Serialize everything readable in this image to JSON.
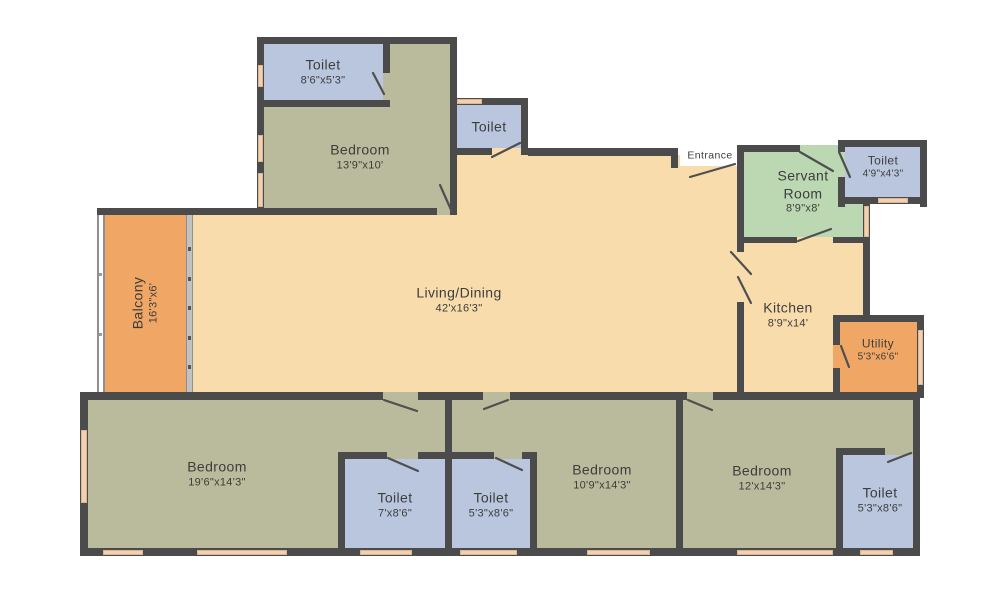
{
  "title": "Apartment Floor Plan",
  "colors": {
    "wall": "#4b4b4b",
    "bedroom": "#b9bb9c",
    "toilet": "#b9c6de",
    "living": "#f8dcab",
    "balcony": "#f0a765",
    "utility": "#f0a765",
    "servant": "#bcd8b3",
    "window": "#f4d0b0",
    "text": "#3d3d3d"
  },
  "rooms": {
    "toilet_tl": {
      "name": "Toilet",
      "dims": "8'6\"x5'3\""
    },
    "bedroom_tl": {
      "name": "Bedroom",
      "dims": "13'9\"x10'"
    },
    "toilet_mid": {
      "name": "Toilet",
      "dims": ""
    },
    "entrance": {
      "name": "Entrance"
    },
    "servant_room": {
      "name": "Servant Room",
      "dims": "8'9\"x8'"
    },
    "toilet_servant": {
      "name": "Toilet",
      "dims": "4'9\"x4'3\""
    },
    "balcony": {
      "name": "Balcony",
      "dims": "16'3\"x6'"
    },
    "living_dining": {
      "name": "Living/Dining",
      "dims": "42'x16'3\""
    },
    "kitchen": {
      "name": "Kitchen",
      "dims": "8'9\"x14'"
    },
    "utility": {
      "name": "Utility",
      "dims": "5'3\"x6'6\""
    },
    "bedroom_1": {
      "name": "Bedroom",
      "dims": "19'6\"x14'3\""
    },
    "toilet_b1": {
      "name": "Toilet",
      "dims": "7'x8'6\""
    },
    "toilet_b2": {
      "name": "Toilet",
      "dims": "5'3\"x8'6\""
    },
    "bedroom_2": {
      "name": "Bedroom",
      "dims": "10'9\"x14'3\""
    },
    "bedroom_3": {
      "name": "Bedroom",
      "dims": "12'x14'3\""
    },
    "toilet_b3": {
      "name": "Toilet",
      "dims": "5'3\"x8'6\""
    }
  }
}
